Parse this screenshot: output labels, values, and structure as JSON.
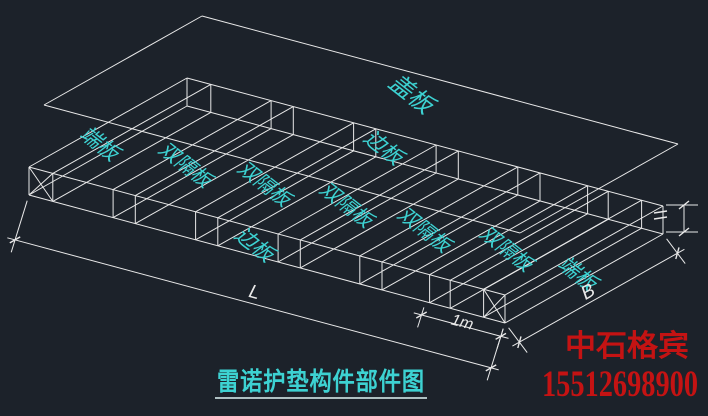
{
  "canvas": {
    "width": 708,
    "height": 416,
    "background": "#1c222a",
    "wire_color": "#e9e9e9",
    "label_color": "#3dd2d2",
    "underline_color": "#dff4f4",
    "accent_red": "#c41313"
  },
  "plate_labels": [
    {
      "text": "盖板",
      "x": 406,
      "y": 100,
      "rot": 38,
      "size": 24
    },
    {
      "text": "端板",
      "x": 95,
      "y": 149,
      "rot": 38,
      "size": 21
    },
    {
      "text": "双隔板",
      "x": 181,
      "y": 170,
      "rot": 38,
      "size": 20
    },
    {
      "text": "双隔板",
      "x": 260,
      "y": 189,
      "rot": 38,
      "size": 20
    },
    {
      "text": "边板",
      "x": 379,
      "y": 153,
      "rot": 38,
      "size": 21
    },
    {
      "text": "双隔板",
      "x": 342,
      "y": 210,
      "rot": 38,
      "size": 20
    },
    {
      "text": "边板",
      "x": 250,
      "y": 250,
      "rot": 38,
      "size": 21
    },
    {
      "text": "双隔板",
      "x": 420,
      "y": 235,
      "rot": 38,
      "size": 20
    },
    {
      "text": "双隔板",
      "x": 502,
      "y": 254,
      "rot": 38,
      "size": 20
    },
    {
      "text": "端板",
      "x": 573,
      "y": 279,
      "rot": 38,
      "size": 21
    }
  ],
  "dimensions": [
    {
      "text": "L",
      "x": 253,
      "y": 298,
      "rot": 15,
      "size": 19
    },
    {
      "text": "1m",
      "x": 461,
      "y": 327,
      "rot": 15,
      "size": 16
    },
    {
      "text": "B",
      "x": 591,
      "y": 297,
      "rot": -30,
      "size": 19
    }
  ],
  "title": {
    "text": "雷诺护垫构件部件图"
  },
  "watermark": {
    "company": "中石格宾",
    "phone": "15512698900"
  }
}
